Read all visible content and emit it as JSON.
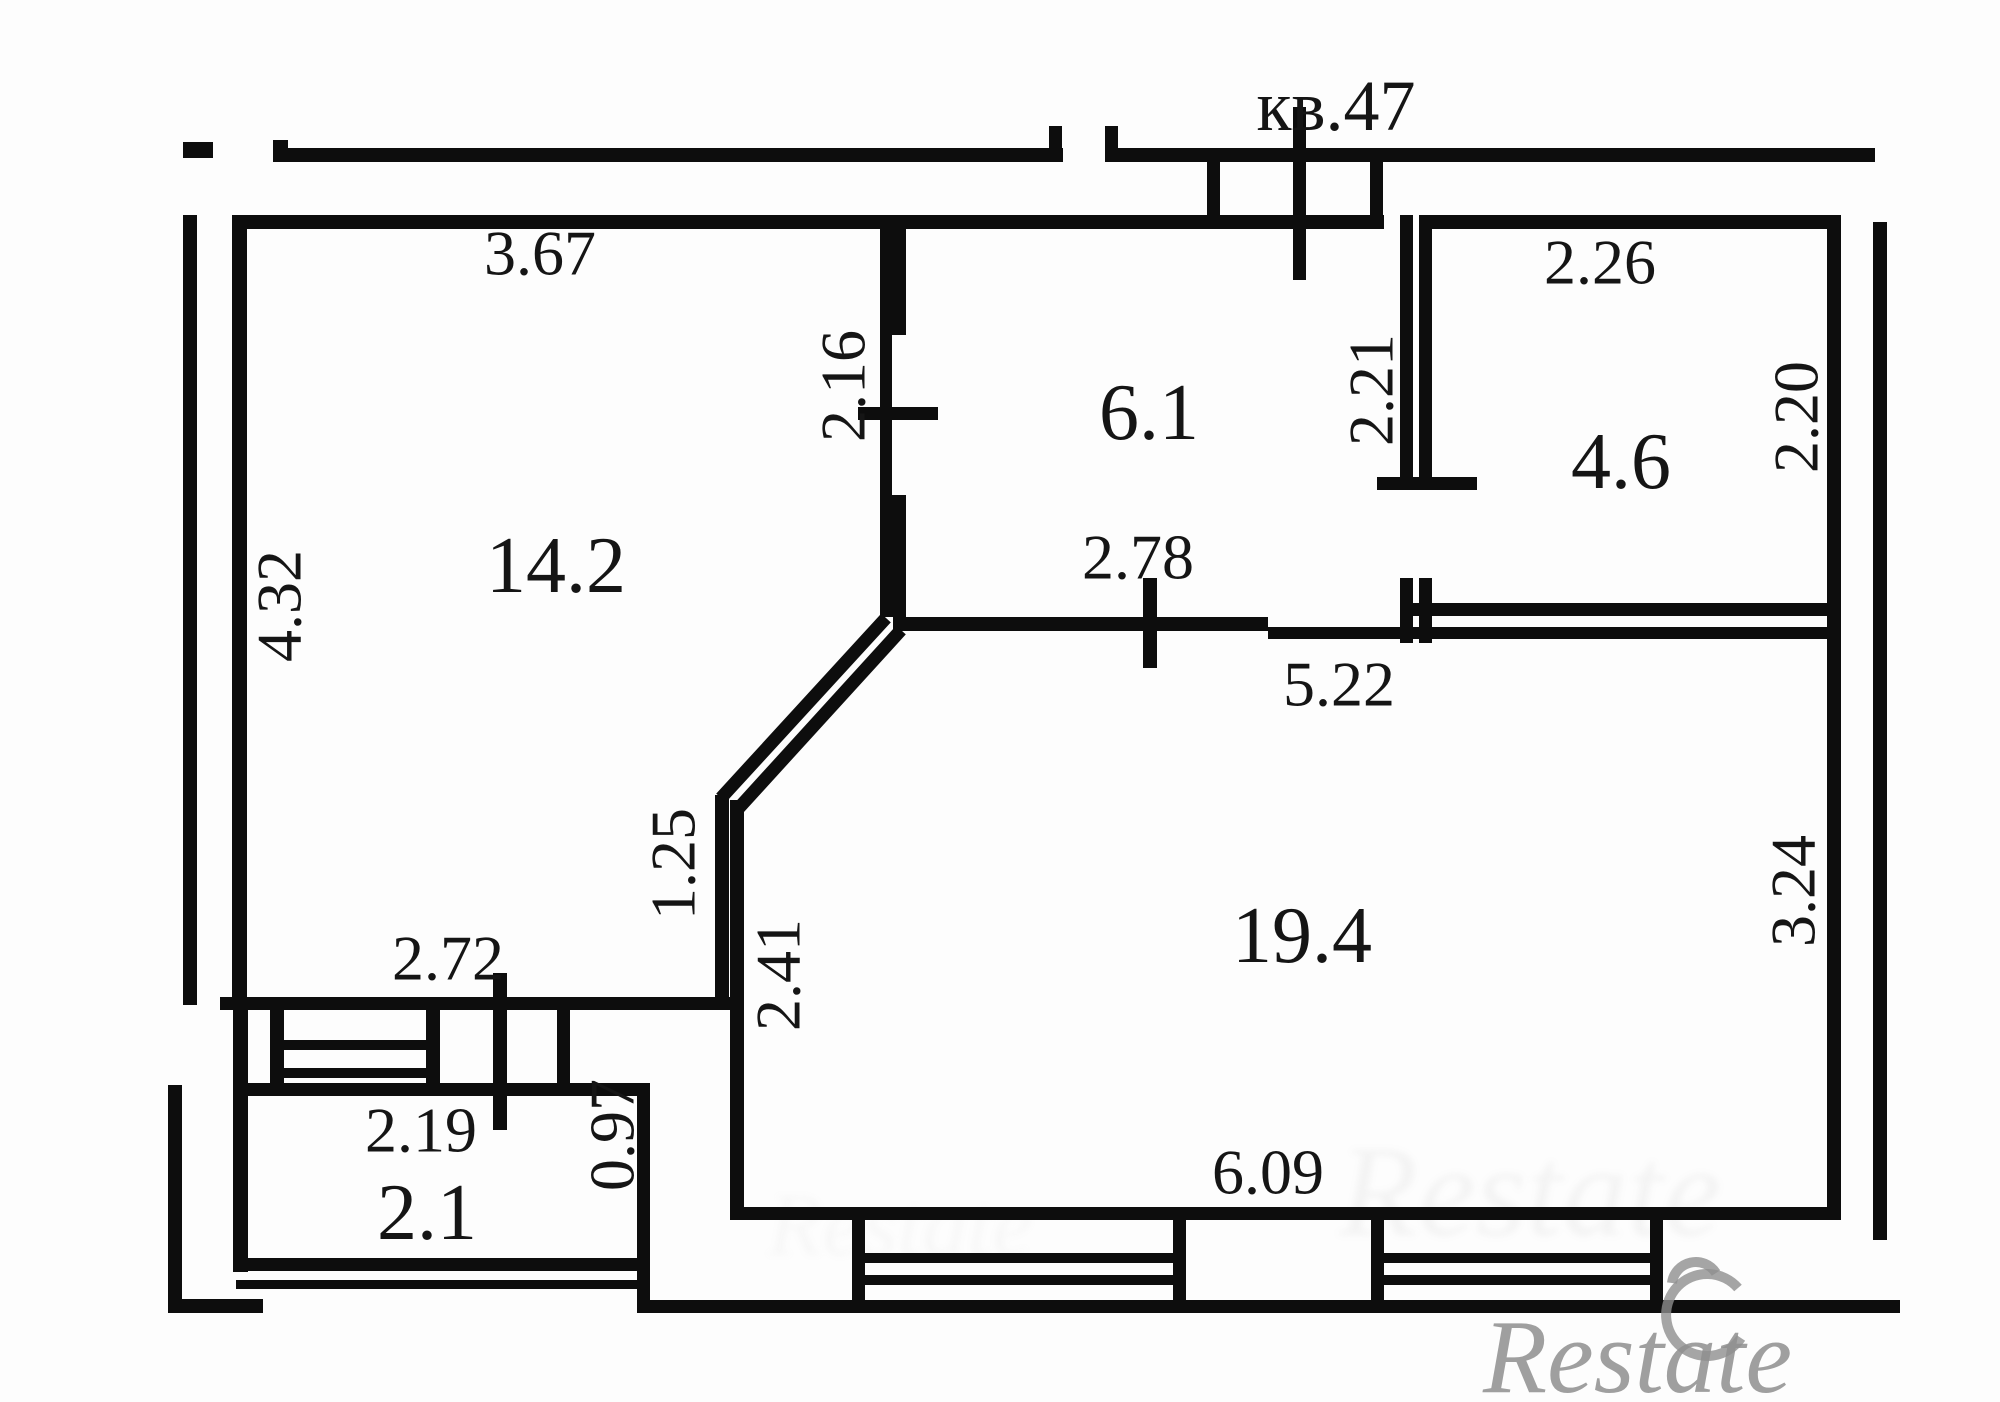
{
  "plan": {
    "apartment": "кв.47",
    "rooms": {
      "room_14_2": "14.2",
      "room_6_1": "6.1",
      "room_4_6": "4.6",
      "room_19_4": "19.4",
      "balcony": "2.1"
    },
    "dimensions": {
      "room14_top": "3.67",
      "room14_left": "4.32",
      "room14_bottom": "2.72",
      "door_room14_room6": "2.16",
      "room6_door_bottom": "2.78",
      "room19_top": "5.22",
      "door_room6_room4": "2.21",
      "room4_top": "2.26",
      "room4_right": "2.20",
      "diag_upper": "1.25",
      "diag_lower": "2.41",
      "room19_right": "3.24",
      "room19_bottom": "6.09",
      "balcony_door": "2.19",
      "balcony_right": "0.97"
    }
  },
  "watermark": {
    "brand": "Restate"
  }
}
